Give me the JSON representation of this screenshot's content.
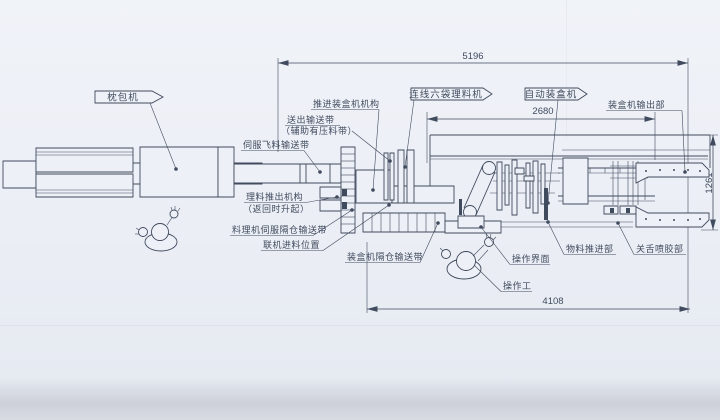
{
  "drawing": {
    "title_flags": {
      "pillow_machine": "枕包机",
      "inline_six_bag_sorter": "连线六袋理料机",
      "auto_cartoner": "自动装盒机"
    },
    "labels": {
      "push_into_cartoner_mechanism": "推进装盒机机构",
      "outfeed_conveyor": "送出输送带",
      "outfeed_conveyor_note": "（辅助有压料带）",
      "servo_fly_material_conveyor": "伺服飞料输送带",
      "sorter_pushout_mechanism": "理料推出机构",
      "sorter_pushout_note": "（返回时升起）",
      "sorter_servo_compartment_conveyor": "料理机伺服隔仓输送带",
      "inline_infeed_position": "联机进料位置",
      "cartoner_compartment_conveyor": "装盒机隔仓输送带",
      "cartoner_output_section": "装盒机输出部",
      "operation_interface": "操作界面",
      "operator": "操作工",
      "material_push_section": "物料推进部",
      "tongue_close_glue_section": "关舌喷胶部"
    },
    "dimensions": {
      "overall_length": "5196",
      "cartoner_frame_length": "2680",
      "line_length": "4108",
      "machine_height": "1261"
    },
    "colors": {
      "ink": "#414b5e",
      "paper": "#edf0f6"
    }
  }
}
